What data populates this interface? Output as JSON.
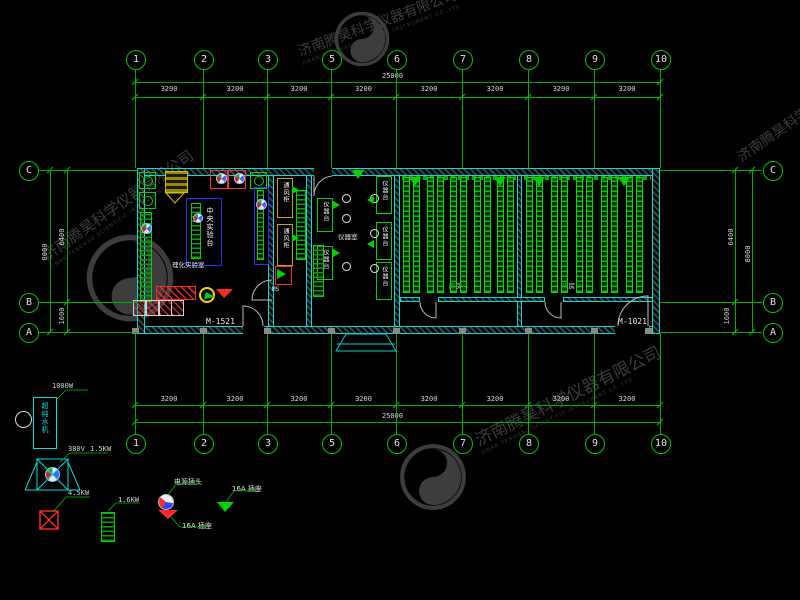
{
  "watermark": {
    "cn": "济南腾昊科学仪器有限公司",
    "en": "JINAN TENGHAO SCIENTIFIC INSTRUMENT CO.,LTD"
  },
  "axes": {
    "cols": [
      "1",
      "2",
      "3",
      "5",
      "6",
      "7",
      "8",
      "9",
      "10"
    ],
    "rows": [
      "C",
      "B",
      "A"
    ]
  },
  "dims": {
    "total_top": "25000",
    "total_bottom": "25000",
    "bay": "3200",
    "side_upper": "6400",
    "side_lower": "1600",
    "side_total": "8000"
  },
  "plan": {
    "door_left": "M-1521",
    "door_right": "M-1021",
    "room1": "理化实验室",
    "room3": "仪器室",
    "room4": "库房 1",
    "room5": "库房 2",
    "central_bench": "中央实验台",
    "fume_hood": "通风柜",
    "instrument_bench": "仪器台",
    "ms": "MS"
  },
  "legend": {
    "water_machine": {
      "text": "超纯水机",
      "power": "1000W"
    },
    "fan": {
      "voltage": "380V",
      "power": "1.5KW"
    },
    "heater": {
      "power": "4.5KW"
    },
    "radiator": {
      "power": "1.6KW"
    },
    "plug": {
      "label": "电源插头"
    },
    "socket_red": {
      "label": "16A 插座"
    },
    "socket_green": {
      "label": "16A 插座"
    }
  },
  "colors": {
    "grid": "#00b000",
    "wall": "#00dede",
    "equip": "#00d400",
    "red": "#ff2a2a",
    "yellow": "#d8c000",
    "bench_blue": "#2b2bff",
    "watermark": "#3d3d3d"
  }
}
